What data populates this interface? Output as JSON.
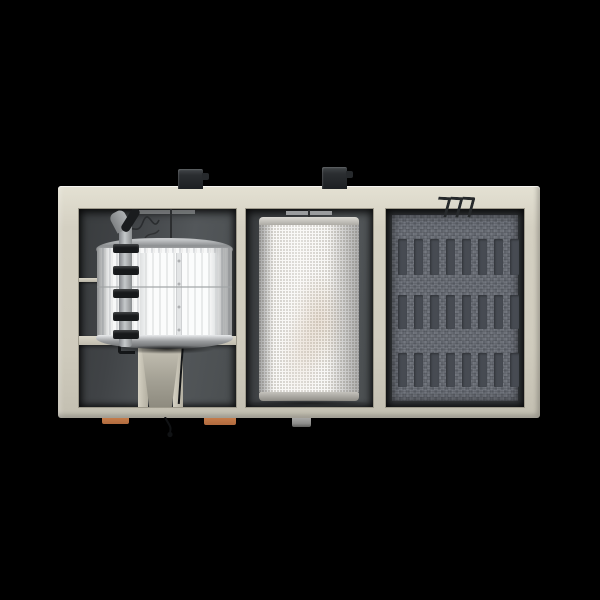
{
  "scene": {
    "description": "3D rendering of an industrial air handling and filtration unit, top-down cutaway view on a black background, with three compartments: metallic fan drum with supply pipe and clamps, white perforated rotary filter drum, and dark heat-exchanger coil media",
    "text_content": "none"
  },
  "colors": {
    "bg": "#000000",
    "casing": "#d4d0c2",
    "casing-light": "#e4e1d3",
    "casing-dark": "#b3afa1",
    "interior-dark": "#404346",
    "interior-mid": "#4a4e50",
    "pipe-gray": "#c6c9cb",
    "clamp-black": "#17191b",
    "drum-bright": "#f7f8f8",
    "drum-metal": "#9a9c9e",
    "rim-metal": "#a8a6a0",
    "filter-white": "#f8f7f5",
    "filter-dot": "#cfccc6",
    "media-base": "#676b73",
    "media-slot": "#474b52",
    "media-frame": "#34373a",
    "box-black": "#1d2023",
    "foot-copper": "#b06a3e",
    "foot-gray": "#8e8e8c",
    "cable-black": "#141618",
    "pedestal": "#a5a296"
  },
  "components": {
    "unit": "air-handling-unit-casing",
    "left_section": "fan-drum-section",
    "middle_section": "rotary-filter-section",
    "right_section": "coil-media-section",
    "top_attachments": [
      "junction-box",
      "junction-box"
    ],
    "feet": [
      "copper-foot",
      "copper-foot",
      "gray-foot"
    ],
    "details": [
      "supply-pipe",
      "pipe-clamps",
      "support-pedestal",
      "coil-hooks",
      "hanging-cable"
    ]
  },
  "coil_section": {
    "rows": [
      {
        "top": 24,
        "height": 36
      },
      {
        "top": 80,
        "height": 34
      },
      {
        "top": 138,
        "height": 34
      }
    ],
    "slots_per_row": 8
  },
  "pipe_clamps": {
    "tops": [
      35,
      57,
      80,
      103,
      121
    ]
  }
}
